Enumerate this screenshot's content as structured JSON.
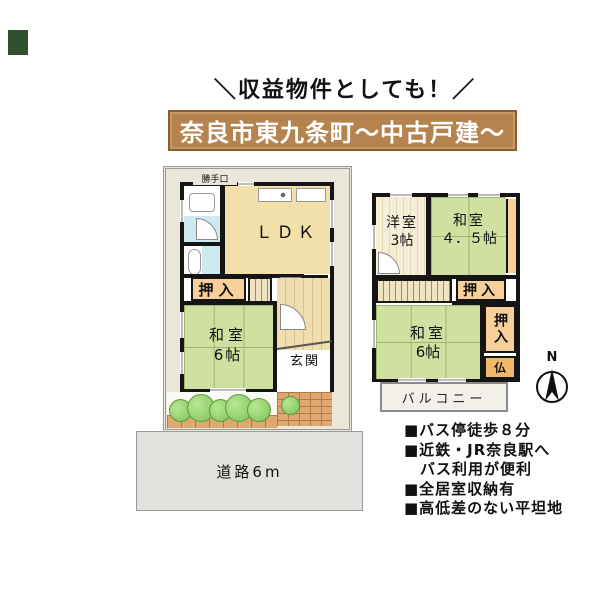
{
  "corner_mark_color": "#2f4f2f",
  "slogan": "＼収益物件としても！／",
  "banner": {
    "text": "奈良市東九条町～中古戸建～",
    "bg": "#b5834e",
    "border": "#8a5e33"
  },
  "floor1": {
    "katteguchi": "勝手口",
    "ldk": "ＬＤＫ",
    "wc": "WC",
    "oshiire": "押入",
    "washitsu_name": "和室",
    "washitsu_size": "6帖",
    "genkan": "玄関"
  },
  "floor2": {
    "yoshitsu_name": "洋室",
    "yoshitsu_size": "3帖",
    "washitsu45_name": "和室",
    "washitsu45_size": "４．５帖",
    "oshiire_upper": "押入",
    "washitsu6_name": "和室",
    "washitsu6_size": "6帖",
    "oshiire_side": "押入",
    "butsudan": "仏",
    "balcony": "バルコニー"
  },
  "road_label": "道路6m",
  "compass_north": "N",
  "features": [
    "■バス停徒歩８分",
    "■近鉄・JR奈良駅へ",
    "　バス利用が便利",
    "■全居室収納有",
    "■高低差のない平坦地"
  ],
  "colors": {
    "tatami": "#cfe0a0",
    "closet": "#f7cf9b",
    "ldk_floor": "#f2dfa9",
    "water_blue": "#cfe9f1",
    "wall": "#151515",
    "road_bg": "#e1e1de"
  }
}
